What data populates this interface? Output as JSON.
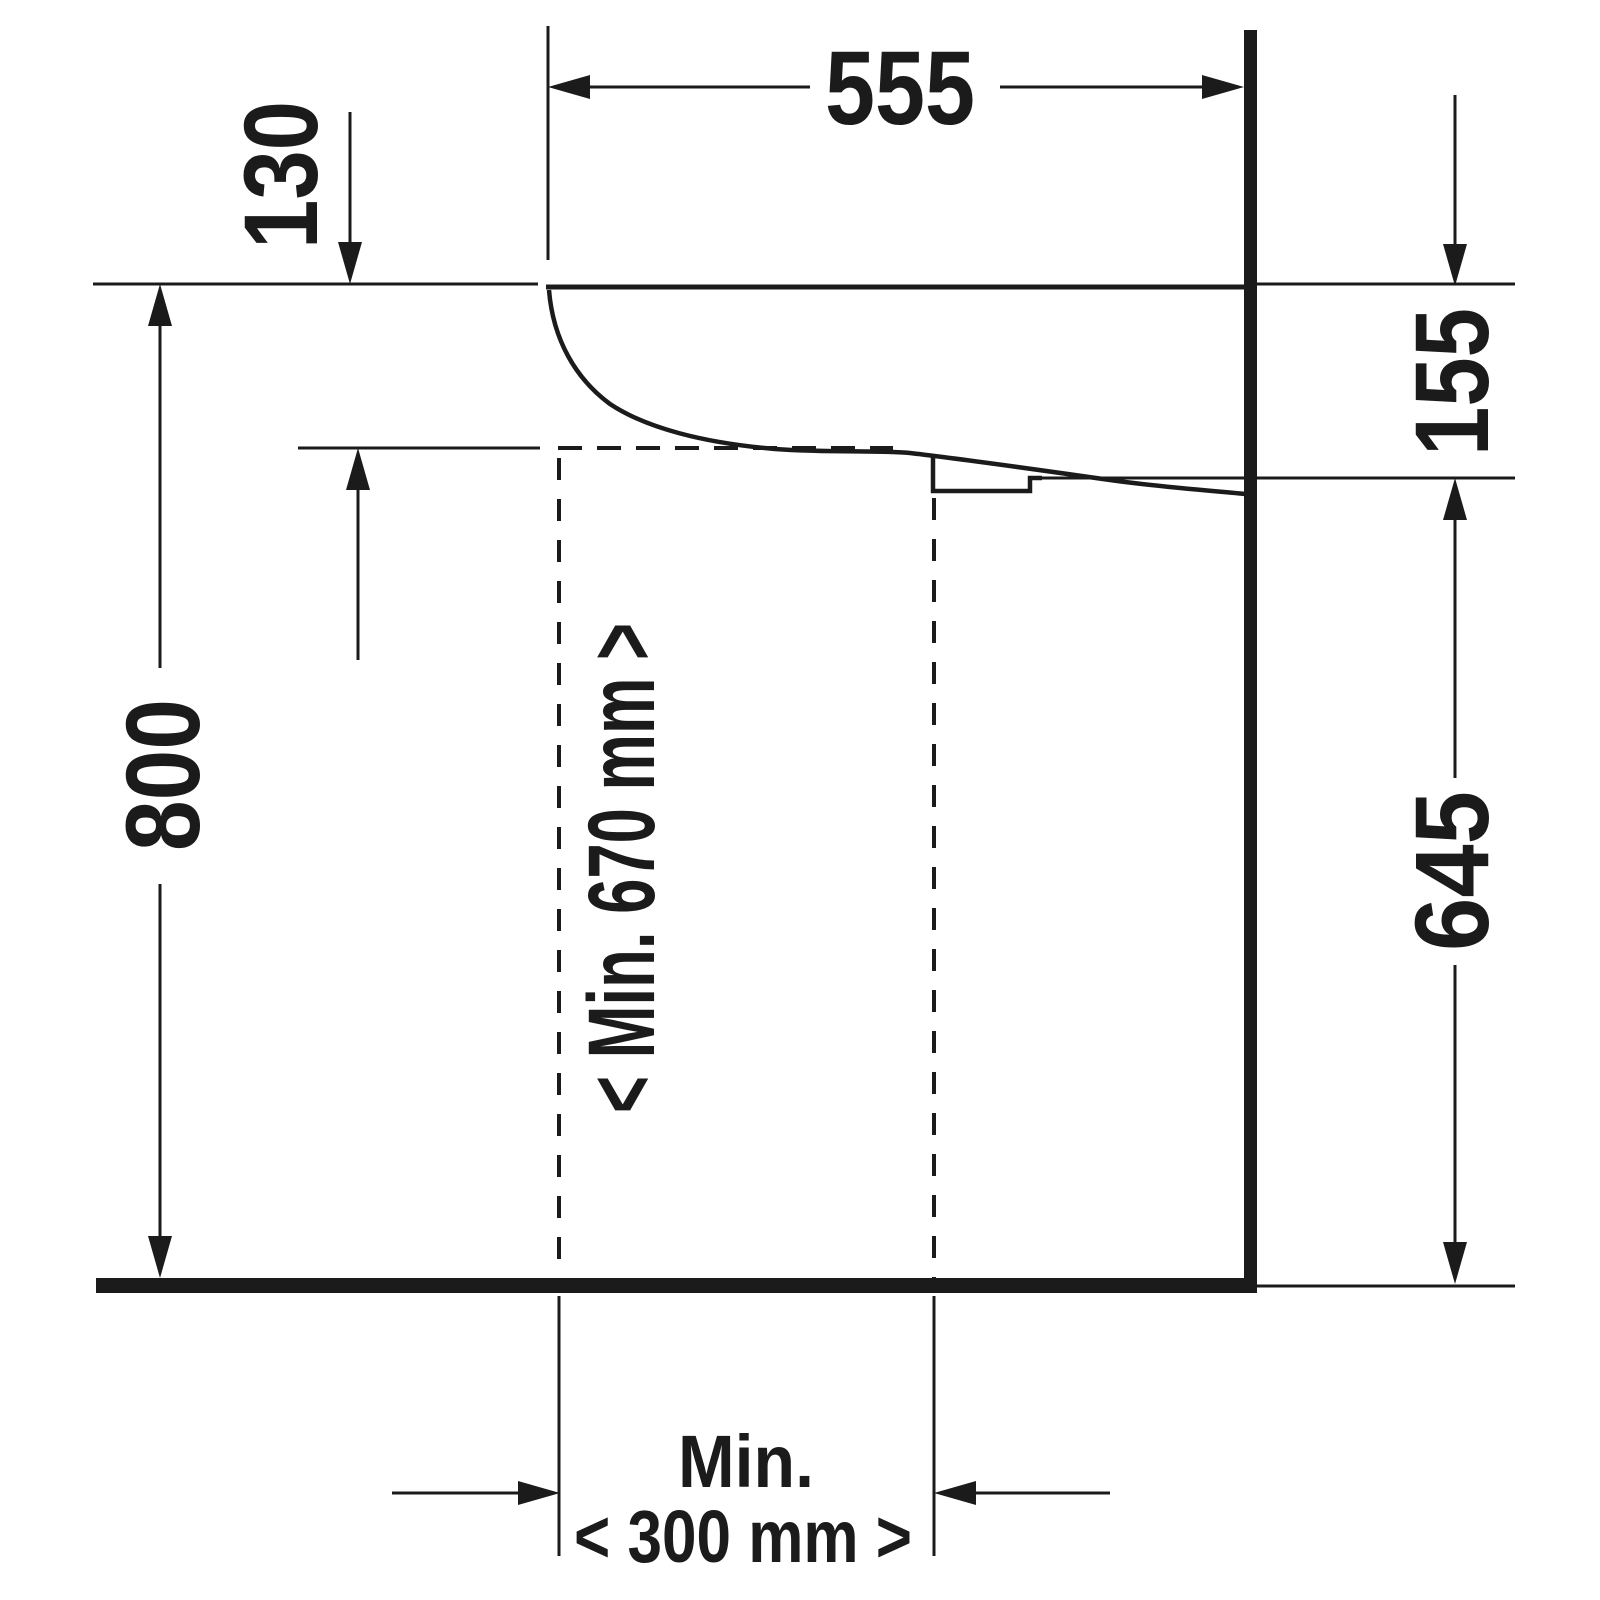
{
  "drawing": {
    "description": "Technical installation drawing, wall-mounted washbasin side elevation with accessibility clearances",
    "unit": "mm",
    "colors": {
      "ink": "#1b1b1b",
      "background": "#ffffff"
    },
    "dimensions": {
      "basin_width": "555",
      "front_edge_height": "130",
      "rim_to_underside_at_wall": "155",
      "rim_height_above_floor": "800",
      "underside_to_floor": "645",
      "knee_clearance_height": "< Min. 670 mm >",
      "knee_clearance_width_label": "Min.",
      "knee_clearance_width": "< 300 mm >"
    }
  }
}
